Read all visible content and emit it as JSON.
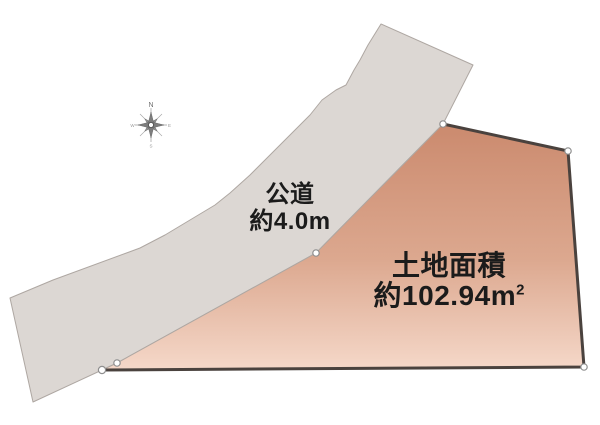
{
  "page": {
    "background": "#ffffff"
  },
  "compass": {
    "north_label": "N",
    "east_label": "E",
    "south_label": "S",
    "west_label": "W"
  },
  "road": {
    "name": "公道",
    "width_note": "約4.0m",
    "fill": "#dcd7d3",
    "edge_color": "#aea7a2"
  },
  "parcel": {
    "area_title": "土地面積",
    "area_value": "約102.94m",
    "area_sup": "2",
    "fill_top": "#cb8a6e",
    "fill_mid": "#dca88f",
    "fill_bottom": "#f5d8c9",
    "border_color": "#4a423e",
    "vertex_dot_fill": "#ffffff",
    "vertex_dot_stroke": "#8f8f8f"
  }
}
